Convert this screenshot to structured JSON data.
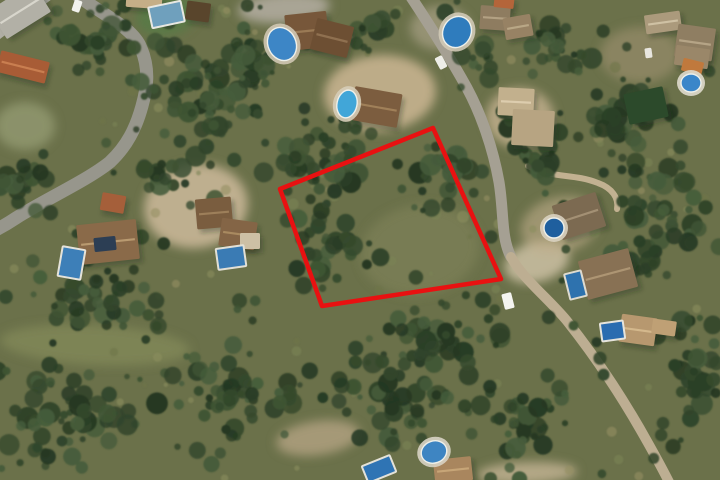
{
  "scene": {
    "width": 720,
    "height": 480,
    "background": "#6b714a",
    "seed": 1337
  },
  "palette": {
    "plot_red": "#e81111",
    "tree_greens": [
      "#35492d",
      "#2b3f26",
      "#3f5434",
      "#253822",
      "#465c3b",
      "#31452b"
    ],
    "scrub_lights": [
      "#7c8355",
      "#8a8e5e",
      "#6e7549",
      "#948f63"
    ],
    "road_gray": "#97968c",
    "dirt_tan": "#c3b292",
    "pool_blue": "#3a7fb8"
  },
  "plot_boundary": {
    "points": [
      [
        433,
        128
      ],
      [
        280,
        189
      ],
      [
        322,
        306
      ],
      [
        501,
        279
      ]
    ],
    "color": "#e81111",
    "stroke_width": 4.5
  },
  "roads": [
    {
      "name": "road-west",
      "d": "M 76,-6 C 100,14 132,26 141,48 C 150,70 147,88 142,106 C 136,128 127,146 110,162 C 88,180 44,200 16,218 C 4,226 -4,230 -10,233",
      "width": 13,
      "color": "#97968c"
    },
    {
      "name": "road-main-north",
      "d": "M 409,-6 C 425,18 447,52 467,88 C 481,114 493,148 499,182 C 504,212 501,238 511,257",
      "width": 11,
      "color": "#a5a093"
    },
    {
      "name": "road-main-south",
      "d": "M 511,257 C 523,279 549,299 567,321 C 594,355 623,398 648,443 C 657,459 664,472 670,484",
      "width": 10,
      "color": "#bdae92"
    },
    {
      "name": "road-corner-nw",
      "d": "M -8,30 L 44,-10",
      "width": 24,
      "color": "#b0aea4"
    },
    {
      "name": "lane-midright",
      "d": "M 528,166 C 553,179 573,173 598,183 C 612,188 619,198 617,209",
      "width": 6,
      "color": "#c2b191"
    }
  ],
  "ground_patches": [
    {
      "name": "lawn-topleft",
      "cx": 166,
      "cy": 16,
      "rx": 30,
      "ry": 20,
      "rot": -10,
      "fill": "#5a7a46",
      "op": 0.95
    },
    {
      "name": "dirt-left-villa",
      "cx": 196,
      "cy": 206,
      "rx": 52,
      "ry": 42,
      "rot": -8,
      "fill": "#c3b292",
      "op": 0.95
    },
    {
      "name": "dirt-mid-top",
      "cx": 380,
      "cy": 93,
      "rx": 56,
      "ry": 38,
      "rot": -4,
      "fill": "#c6b38f",
      "op": 0.9
    },
    {
      "name": "dirt-topright",
      "cx": 520,
      "cy": 118,
      "rx": 34,
      "ry": 30,
      "rot": 0,
      "fill": "#bfae8c",
      "op": 0.85
    },
    {
      "name": "driveway-top-center",
      "cx": 284,
      "cy": 8,
      "rx": 46,
      "ry": 15,
      "rot": -4,
      "fill": "#b0ab9d",
      "op": 0.9
    },
    {
      "name": "dirt-road-top",
      "cx": 440,
      "cy": 28,
      "rx": 30,
      "ry": 22,
      "rot": 0,
      "fill": "#b3a88f",
      "op": 0.6
    },
    {
      "name": "dirt-bottom-center",
      "cx": 318,
      "cy": 438,
      "rx": 42,
      "ry": 17,
      "rot": -8,
      "fill": "#b4a482",
      "op": 0.8
    },
    {
      "name": "dirt-bottom-right",
      "cx": 527,
      "cy": 473,
      "rx": 50,
      "ry": 11,
      "rot": -2,
      "fill": "#c0b091",
      "op": 0.85
    },
    {
      "name": "parking-midright",
      "cx": 537,
      "cy": 262,
      "rx": 33,
      "ry": 20,
      "rot": -15,
      "fill": "#c8bca0",
      "op": 0.9
    },
    {
      "name": "terrace-midright",
      "cx": 560,
      "cy": 225,
      "rx": 40,
      "ry": 28,
      "rot": -15,
      "fill": "#c0ad8a",
      "op": 0.6
    },
    {
      "name": "dirt-bigvilla",
      "cx": 640,
      "cy": 55,
      "rx": 40,
      "ry": 28,
      "rot": 0,
      "fill": "#a99877",
      "op": 0.5
    },
    {
      "name": "scrub-light-west",
      "cx": 25,
      "cy": 126,
      "rx": 30,
      "ry": 24,
      "rot": 0,
      "fill": "#98a078",
      "op": 0.7
    },
    {
      "name": "scrub-band-bottomleft",
      "cx": 95,
      "cy": 345,
      "rx": 95,
      "ry": 20,
      "rot": 3,
      "fill": "#8d935f",
      "op": 0.55
    },
    {
      "name": "scrub-light-plot",
      "cx": 420,
      "cy": 250,
      "rx": 60,
      "ry": 45,
      "rot": -10,
      "fill": "#85885c",
      "op": 0.5
    }
  ],
  "buildings": [
    {
      "name": "gray-roofs-nw-corner",
      "x": -6,
      "y": -6,
      "w": 52,
      "h": 34,
      "rot": -32,
      "fill": "#b2b0a6",
      "ridge": "#d8d6cc"
    },
    {
      "name": "terracotta-house-nw",
      "x": -2,
      "y": 56,
      "w": 50,
      "h": 22,
      "rot": 14,
      "fill": "#a85c36",
      "ridge": "#c97e50"
    },
    {
      "name": "tan-roof-top-strip",
      "x": 126,
      "y": -4,
      "w": 36,
      "h": 12,
      "rot": 4,
      "fill": "#c5ae87"
    },
    {
      "name": "pool-house-top",
      "x": 186,
      "y": 2,
      "w": 24,
      "h": 19,
      "rot": 8,
      "fill": "#59452c"
    },
    {
      "name": "villa-top-center-a",
      "x": 286,
      "y": 13,
      "w": 42,
      "h": 36,
      "rot": -6,
      "fill": "#77573a",
      "ridge": "#9a7a55"
    },
    {
      "name": "villa-top-center-b",
      "x": 313,
      "y": 22,
      "w": 38,
      "h": 32,
      "rot": 14,
      "fill": "#6d4f33",
      "ridge": "#8f7050"
    },
    {
      "name": "villa-mid-top",
      "x": 352,
      "y": 90,
      "w": 48,
      "h": 34,
      "rot": 10,
      "fill": "#7c5d3f",
      "ridge": "#a08059"
    },
    {
      "name": "house-topright-a",
      "x": 480,
      "y": 6,
      "w": 30,
      "h": 24,
      "rot": 4,
      "fill": "#8e7c60",
      "ridge": "#b3a183"
    },
    {
      "name": "house-topright-b",
      "x": 504,
      "y": 16,
      "w": 28,
      "h": 22,
      "rot": -10,
      "fill": "#978264",
      "ridge": "#b9a786"
    },
    {
      "name": "terracotta-roof-topright",
      "x": 494,
      "y": -3,
      "w": 20,
      "h": 11,
      "rot": 6,
      "fill": "#b4653a"
    },
    {
      "name": "bigvilla-roof-a",
      "x": 645,
      "y": 13,
      "w": 36,
      "h": 19,
      "rot": -8,
      "fill": "#ab9a7c",
      "ridge": "#cfc1a4"
    },
    {
      "name": "bigvilla-roof-b",
      "x": 676,
      "y": 26,
      "w": 38,
      "h": 33,
      "rot": 8,
      "fill": "#8f7e62",
      "ridge": "#b5a486"
    },
    {
      "name": "bigvilla-roof-c",
      "x": 675,
      "y": 47,
      "w": 34,
      "h": 20,
      "rot": 8,
      "fill": "#9a8769"
    },
    {
      "name": "bigvilla-awning",
      "x": 682,
      "y": 60,
      "w": 21,
      "h": 13,
      "rot": 14,
      "fill": "#c0793d"
    },
    {
      "name": "green-court",
      "x": 626,
      "y": 90,
      "w": 40,
      "h": 31,
      "rot": -12,
      "fill": "#2c4a2b"
    },
    {
      "name": "tan-house-a",
      "x": 498,
      "y": 88,
      "w": 36,
      "h": 28,
      "rot": 3,
      "fill": "#c2b08d",
      "ridge": "#ddcdae"
    },
    {
      "name": "tan-house-b",
      "x": 512,
      "y": 110,
      "w": 42,
      "h": 36,
      "rot": 3,
      "fill": "#b7a482"
    },
    {
      "name": "outbuilding-terracotta",
      "x": 101,
      "y": 194,
      "w": 24,
      "h": 18,
      "rot": 10,
      "fill": "#a55f3a"
    },
    {
      "name": "villa-left-main",
      "x": 78,
      "y": 222,
      "w": 60,
      "h": 40,
      "rot": -6,
      "fill": "#8a6a49",
      "ridge": "#b99a70"
    },
    {
      "name": "villa-left-solar-panels",
      "x": 94,
      "y": 237,
      "w": 22,
      "h": 14,
      "rot": -6,
      "fill": "#2c3e54"
    },
    {
      "name": "villa-center-a",
      "x": 196,
      "y": 198,
      "w": 36,
      "h": 30,
      "rot": -5,
      "fill": "#7a5d3f",
      "ridge": "#9d7f5a"
    },
    {
      "name": "villa-center-b",
      "x": 220,
      "y": 220,
      "w": 36,
      "h": 28,
      "rot": 8,
      "fill": "#846546",
      "ridge": "#a98a60"
    },
    {
      "name": "patio-center",
      "x": 240,
      "y": 233,
      "w": 20,
      "h": 16,
      "rot": 0,
      "fill": "#cdc0a5"
    },
    {
      "name": "villa-midright-1",
      "x": 556,
      "y": 198,
      "w": 46,
      "h": 36,
      "rot": -18,
      "fill": "#7c6a51",
      "ridge": "#a39074"
    },
    {
      "name": "villa-midright-2",
      "x": 582,
      "y": 254,
      "w": 52,
      "h": 40,
      "rot": -15,
      "fill": "#887154",
      "ridge": "#ad9573"
    },
    {
      "name": "villa-bottomright-a",
      "x": 620,
      "y": 316,
      "w": 36,
      "h": 28,
      "rot": 8,
      "fill": "#b7986f",
      "ridge": "#d4b88c"
    },
    {
      "name": "villa-bottomright-b",
      "x": 652,
      "y": 320,
      "w": 24,
      "h": 15,
      "rot": 8,
      "fill": "#bfa075"
    },
    {
      "name": "house-bottom-center",
      "x": 434,
      "y": 458,
      "w": 38,
      "h": 24,
      "rot": -6,
      "fill": "#a9865e",
      "ridge": "#c7a577"
    }
  ],
  "pools": [
    {
      "name": "lap-pool-topleft",
      "type": "rect",
      "x": 150,
      "y": 4,
      "w": 33,
      "h": 21,
      "rot": -12,
      "fill": "#6fa0bd",
      "rim": "#e8e8e2"
    },
    {
      "name": "kidney-pool-top-center",
      "type": "ellipse",
      "cx": 282,
      "cy": 44,
      "rx": 14,
      "ry": 17,
      "rot": -24,
      "fill": "#3d86c6",
      "deck": "#cfc6b2"
    },
    {
      "name": "kidney-pool-mid-top",
      "type": "ellipse",
      "cx": 347,
      "cy": 104,
      "rx": 10,
      "ry": 14,
      "rot": 12,
      "fill": "#41a6d8",
      "deck": "#d6cdb8"
    },
    {
      "name": "kidney-pool-topright",
      "type": "ellipse",
      "cx": 457,
      "cy": 32,
      "rx": 14,
      "ry": 16,
      "rot": 28,
      "fill": "#2f7cbd",
      "deck": "#d0c9b6"
    },
    {
      "name": "round-pool-bigvilla",
      "type": "ellipse",
      "cx": 691,
      "cy": 83,
      "rx": 10,
      "ry": 9,
      "rot": 0,
      "fill": "#3a86c9",
      "deck": "#dfdacd"
    },
    {
      "name": "pool-left-villa",
      "type": "rect",
      "x": 60,
      "y": 248,
      "w": 23,
      "h": 30,
      "rot": 10,
      "fill": "#3d7fb8",
      "rim": "#e5e3da"
    },
    {
      "name": "pool-center-villa",
      "type": "rect",
      "x": 217,
      "y": 247,
      "w": 28,
      "h": 21,
      "rot": -8,
      "fill": "#3a7bb4",
      "rim": "#e2e0d6"
    },
    {
      "name": "round-pool-midright",
      "type": "ellipse",
      "cx": 554,
      "cy": 228,
      "rx": 10,
      "ry": 10,
      "rot": 0,
      "fill": "#1f5f9e",
      "deck": "#d9d2c0"
    },
    {
      "name": "pool-midright-2",
      "type": "rect",
      "x": 567,
      "y": 272,
      "w": 17,
      "h": 26,
      "rot": -14,
      "fill": "#2e72ae",
      "rim": "#dedbd0"
    },
    {
      "name": "pool-bottomright",
      "type": "rect",
      "x": 601,
      "y": 322,
      "w": 23,
      "h": 18,
      "rot": -8,
      "fill": "#2a6cb0",
      "rim": "#e6e4dc"
    },
    {
      "name": "oval-pool-bottom",
      "type": "ellipse",
      "cx": 434,
      "cy": 452,
      "rx": 13,
      "ry": 11,
      "rot": -20,
      "fill": "#3e85c2",
      "deck": "#d8d3c4"
    },
    {
      "name": "pool-bottom-center",
      "type": "rect",
      "x": 364,
      "y": 460,
      "w": 30,
      "h": 18,
      "rot": -22,
      "fill": "#2f74b4",
      "rim": "#e4e2d8"
    }
  ],
  "vehicles": [
    {
      "name": "white-car-top-road",
      "x": 73,
      "y": 0,
      "w": 8,
      "h": 12,
      "rot": 18,
      "fill": "#f2f2ee"
    },
    {
      "name": "white-car-main-road",
      "x": 437,
      "y": 56,
      "w": 8,
      "h": 13,
      "rot": -28,
      "fill": "#eeeee8"
    },
    {
      "name": "white-van-midright",
      "x": 503,
      "y": 293,
      "w": 10,
      "h": 16,
      "rot": -14,
      "fill": "#f4f4f0"
    },
    {
      "name": "car-bigvilla",
      "x": 645,
      "y": 48,
      "w": 7,
      "h": 10,
      "rot": -8,
      "fill": "#e8e6df"
    }
  ],
  "tree_clusters": [
    {
      "cx": 210,
      "cy": 100,
      "rx": 70,
      "ry": 75,
      "n": 60
    },
    {
      "cx": 90,
      "cy": 40,
      "rx": 55,
      "ry": 38,
      "n": 30
    },
    {
      "cx": 320,
      "cy": 155,
      "rx": 55,
      "ry": 48,
      "n": 35
    },
    {
      "cx": 255,
      "cy": 60,
      "rx": 40,
      "ry": 35,
      "n": 22
    },
    {
      "cx": 560,
      "cy": 55,
      "rx": 45,
      "ry": 38,
      "n": 25
    },
    {
      "cx": 615,
      "cy": 120,
      "rx": 45,
      "ry": 40,
      "n": 26
    },
    {
      "cx": 660,
      "cy": 220,
      "rx": 62,
      "ry": 85,
      "n": 55
    },
    {
      "cx": 540,
      "cy": 150,
      "rx": 45,
      "ry": 30,
      "n": 20
    },
    {
      "cx": 120,
      "cy": 300,
      "rx": 70,
      "ry": 45,
      "n": 40
    },
    {
      "cx": 60,
      "cy": 420,
      "rx": 85,
      "ry": 60,
      "n": 55
    },
    {
      "cx": 230,
      "cy": 400,
      "rx": 80,
      "ry": 55,
      "n": 50
    },
    {
      "cx": 400,
      "cy": 390,
      "rx": 80,
      "ry": 55,
      "n": 50
    },
    {
      "cx": 520,
      "cy": 420,
      "rx": 60,
      "ry": 50,
      "n": 38
    },
    {
      "cx": 330,
      "cy": 250,
      "rx": 55,
      "ry": 45,
      "n": 30
    },
    {
      "cx": 450,
      "cy": 180,
      "rx": 45,
      "ry": 40,
      "n": 24
    },
    {
      "cx": 30,
      "cy": 180,
      "rx": 40,
      "ry": 40,
      "n": 22
    },
    {
      "cx": 440,
      "cy": 330,
      "rx": 70,
      "ry": 35,
      "n": 32
    },
    {
      "cx": 160,
      "cy": 180,
      "rx": 35,
      "ry": 25,
      "n": 14
    },
    {
      "cx": 690,
      "cy": 380,
      "rx": 40,
      "ry": 70,
      "n": 30
    },
    {
      "cx": 370,
      "cy": 30,
      "rx": 30,
      "ry": 22,
      "n": 12
    },
    {
      "cx": 480,
      "cy": 60,
      "rx": 25,
      "ry": 25,
      "n": 10
    }
  ],
  "scatter": {
    "uniform_trees": 150,
    "light_dots": 95
  }
}
